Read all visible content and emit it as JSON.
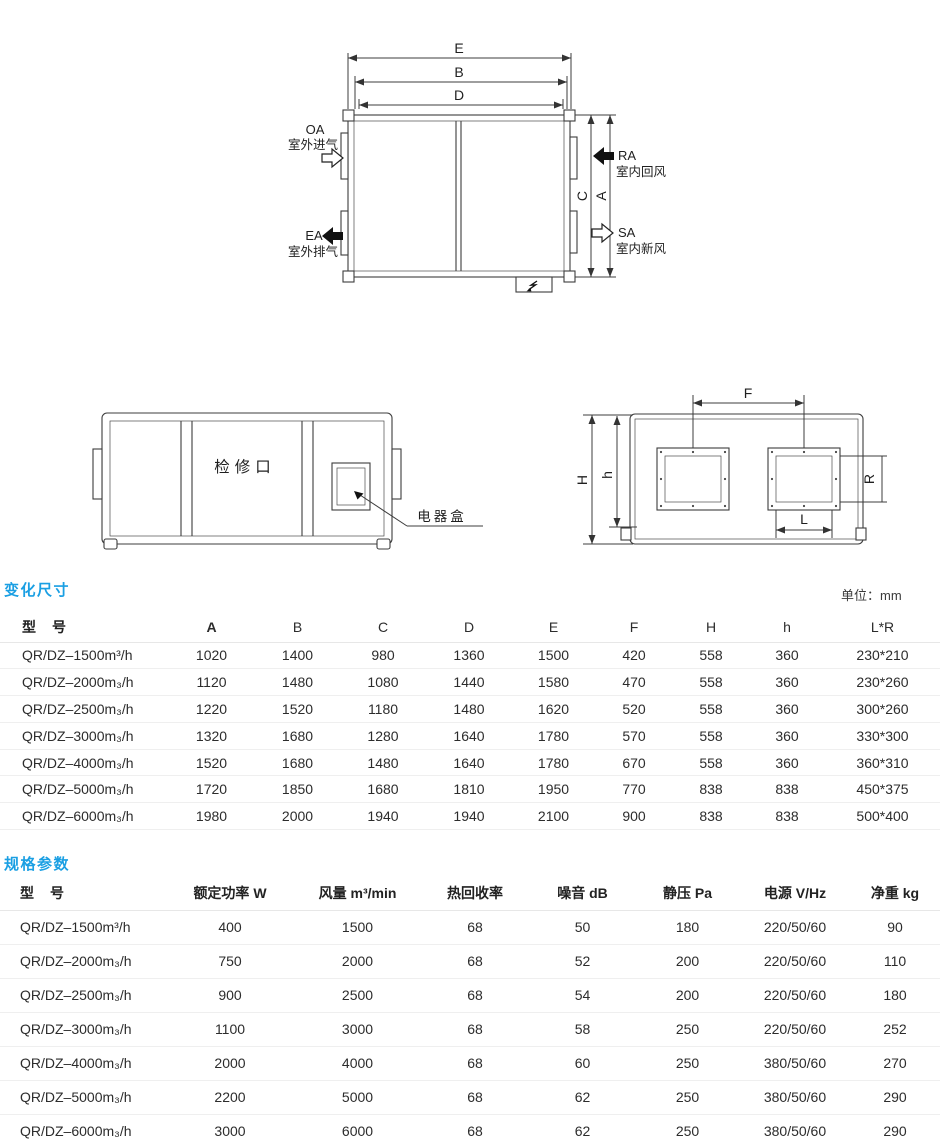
{
  "top_view": {
    "dim_e": "E",
    "dim_b": "B",
    "dim_d": "D",
    "dim_c": "C",
    "dim_a": "A",
    "oa_code": "OA",
    "oa_label": "室外进气",
    "ea_code": "EA",
    "ea_label": "室外排气",
    "ra_code": "RA",
    "ra_label": "室内回风",
    "sa_code": "SA",
    "sa_label": "室内新风"
  },
  "side_view": {
    "access_label": "检修口",
    "ebox_label": "电器盒"
  },
  "end_view": {
    "dim_f": "F",
    "dim_h": "H",
    "dim_h_small": "h",
    "dim_r": "R",
    "dim_l": "L"
  },
  "dimension_section": {
    "title": "变化尺寸",
    "unit_note": "单位：mm",
    "columns": [
      "型　号",
      "A",
      "B",
      "C",
      "D",
      "E",
      "F",
      "H",
      "h",
      "L*R"
    ],
    "rows": [
      [
        "QR/DZ–1500m³/h",
        "1020",
        "1400",
        "980",
        "1360",
        "1500",
        "420",
        "558",
        "360",
        "230*210"
      ],
      [
        "QR/DZ–2000m₃/h",
        "1120",
        "1480",
        "1080",
        "1440",
        "1580",
        "470",
        "558",
        "360",
        "230*260"
      ],
      [
        "QR/DZ–2500m₃/h",
        "1220",
        "1520",
        "1180",
        "1480",
        "1620",
        "520",
        "558",
        "360",
        "300*260"
      ],
      [
        "QR/DZ–3000m₃/h",
        "1320",
        "1680",
        "1280",
        "1640",
        "1780",
        "570",
        "558",
        "360",
        "330*300"
      ],
      [
        "QR/DZ–4000m₃/h",
        "1520",
        "1680",
        "1480",
        "1640",
        "1780",
        "670",
        "558",
        "360",
        "360*310"
      ],
      [
        "QR/DZ–5000m₃/h",
        "1720",
        "1850",
        "1680",
        "1810",
        "1950",
        "770",
        "838",
        "838",
        "450*375"
      ],
      [
        "QR/DZ–6000m₃/h",
        "1980",
        "2000",
        "1940",
        "1940",
        "2100",
        "900",
        "838",
        "838",
        "500*400"
      ]
    ]
  },
  "spec_section": {
    "title": "规格参数",
    "columns": [
      "型　号",
      "额定功率 W",
      "风量 m³/min",
      "热回收率",
      "噪音 dB",
      "静压 Pa",
      "电源 V/Hz",
      "净重 kg"
    ],
    "rows": [
      [
        "QR/DZ–1500m³/h",
        "400",
        "1500",
        "68",
        "50",
        "180",
        "220/50/60",
        "90"
      ],
      [
        "QR/DZ–2000m₃/h",
        "750",
        "2000",
        "68",
        "52",
        "200",
        "220/50/60",
        "110"
      ],
      [
        "QR/DZ–2500m₃/h",
        "900",
        "2500",
        "68",
        "54",
        "200",
        "220/50/60",
        "180"
      ],
      [
        "QR/DZ–3000m₃/h",
        "1100",
        "3000",
        "68",
        "58",
        "250",
        "220/50/60",
        "252"
      ],
      [
        "QR/DZ–4000m₃/h",
        "2000",
        "4000",
        "68",
        "60",
        "250",
        "380/50/60",
        "270"
      ],
      [
        "QR/DZ–5000m₃/h",
        "2200",
        "5000",
        "68",
        "62",
        "250",
        "380/50/60",
        "290"
      ],
      [
        "QR/DZ–6000m₃/h",
        "3000",
        "6000",
        "68",
        "62",
        "250",
        "380/50/60",
        "290"
      ]
    ]
  }
}
